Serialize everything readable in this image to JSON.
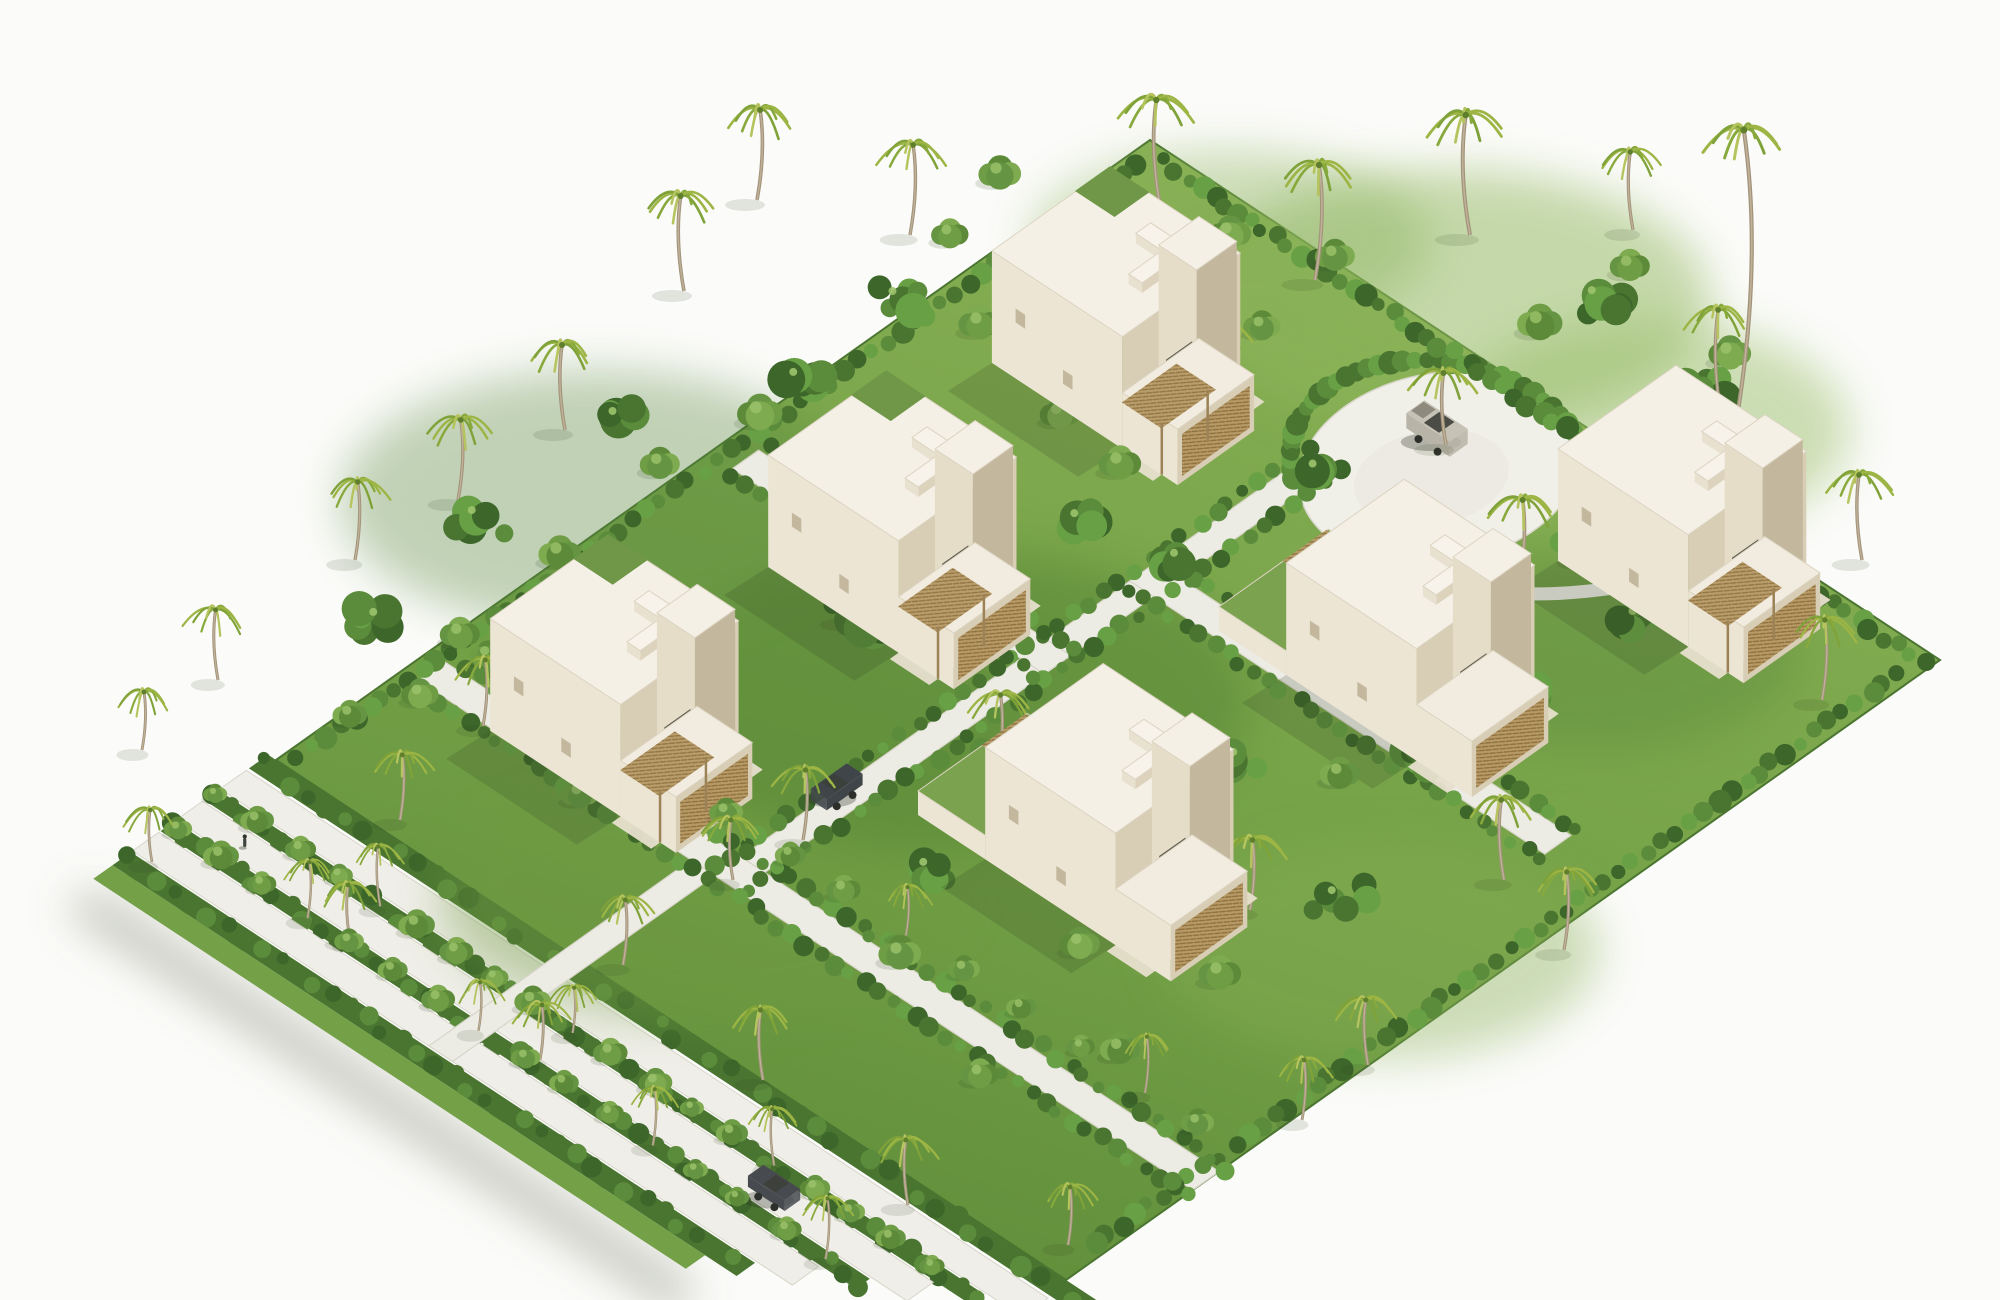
{
  "scene": {
    "description": "Isometric 3D architectural rendering of a tropical villa resort masterplan: six white concrete cube villas with roof terraces and rattan pergolas on a lush green site, a circular paved drop-off plaza with a grey SUV, diagonal white roads lined with hedges and palms, and a landscaped buffer of three parallel tree-lined lanes along the south-west boundary.",
    "palette": {
      "bg": "#fbfbf9",
      "grassHi": "#8ab155",
      "grass": "#74a147",
      "grassLo": "#5e8b39",
      "shrub1": "#3c662a",
      "shrub2": "#4a7531",
      "shrub3": "#5b8c3c",
      "shrub4": "#68a045",
      "leafHi": "#9cc36b",
      "road": "#ecebe4",
      "roadBright": "#efeee8",
      "roadEdge": "#d8d6ca",
      "roofTop": "#f4f0e6",
      "wallL": "#ece5d4",
      "wallR": "#d8cdb5",
      "wallShade": "#c3b89d",
      "rattan": "#b79a66",
      "rattanLine": "#8f713f",
      "glass": "#5c5b4e",
      "trunk": "#a2937a",
      "palmA": "#9cb544",
      "palmB": "#7fa239",
      "palmC": "#b5c45e",
      "palmD": "#88a93c",
      "treeA": "#5d8a39",
      "treeB": "#6f9d45",
      "treeC": "#7fab50",
      "treeD": "#659542",
      "suv": "#b8b4a7",
      "carDark": "#40454a",
      "shadow": "rgba(45,62,30,0.25)",
      "buildingShadow": "rgba(47,61,31,0.18)"
    },
    "villa_style": {
      "w": 0.165,
      "d": 0.135,
      "h": 112,
      "wing_h": 56,
      "tower_h": 126,
      "court_wall_h": 24
    },
    "villas": [
      {
        "id": "villa-1",
        "u": 0.185,
        "v": 0.206,
        "court": false,
        "green_roof": true,
        "pergola": true
      },
      {
        "id": "villa-2",
        "u": 0.227,
        "v": 0.5,
        "court": false,
        "green_roof": true,
        "pergola": true
      },
      {
        "id": "villa-3",
        "u": 0.196,
        "v": 0.79,
        "court": false,
        "green_roof": true,
        "pergola": true
      },
      {
        "id": "villa-4",
        "u": 0.64,
        "v": 0.625,
        "court": true,
        "green_roof": false,
        "pergola": false
      },
      {
        "id": "villa-5",
        "u": 0.667,
        "v": 0.305,
        "court": true,
        "green_roof": false,
        "pergola": false
      },
      {
        "id": "villa-6",
        "u": 0.74,
        "v": 0.06,
        "court": false,
        "green_roof": false,
        "pergola": true
      }
    ],
    "roundabout": {
      "u": 0.494,
      "v": 0.115,
      "rx": 142,
      "ry": 95,
      "rot": -10,
      "palm_base": [
        1446,
        445
      ]
    },
    "roads": [
      {
        "name": "spine-road",
        "axis": "v",
        "u": [
          0.395,
          0.425
        ],
        "v": [
          0.16,
          0.855
        ]
      },
      {
        "name": "cross-road-west",
        "axis": "u",
        "u": [
          0.03,
          0.425
        ],
        "v": [
          0.475,
          0.505
        ]
      },
      {
        "name": "cross-road-east",
        "axis": "u",
        "u": [
          0.395,
          0.92
        ],
        "v": [
          0.35,
          0.38
        ]
      },
      {
        "name": "southwest-boundary-road",
        "axis": "u",
        "u": [
          0.02,
          1.0
        ],
        "v": [
          0.825,
          0.855
        ]
      },
      {
        "name": "spine-connector",
        "axis": "v",
        "u": [
          0.365,
          0.395
        ],
        "v": [
          0.855,
          1.155
        ]
      }
    ],
    "path_to_villa6": [
      [
        0.565,
        0.185
      ],
      [
        0.625,
        0.225
      ],
      [
        0.69,
        0.16
      ],
      [
        0.73,
        0.105
      ]
    ],
    "strips": {
      "bands": [
        {
          "type": "hedge",
          "v": [
            1.0,
            1.022
          ],
          "uEnd": 1.04
        },
        {
          "type": "road",
          "v": [
            1.025,
            1.055
          ],
          "uEnd": 1.005
        },
        {
          "type": "hedge",
          "v": [
            1.057,
            1.073
          ],
          "uEnd": 0.96
        },
        {
          "type": "road",
          "v": [
            1.075,
            1.105
          ],
          "uEnd": 0.915
        },
        {
          "type": "hedge",
          "v": [
            1.107,
            1.123
          ],
          "uEnd": 0.87
        },
        {
          "type": "road",
          "v": [
            1.125,
            1.155
          ],
          "uEnd": 0.825
        },
        {
          "type": "hedge",
          "v": [
            1.157,
            1.178
          ],
          "uEnd": 0.78
        },
        {
          "type": "grass",
          "v": [
            1.178,
            1.2
          ],
          "uEnd": 0.74
        }
      ],
      "uStart": -0.01,
      "tree_rows": [
        {
          "v": 1.065,
          "uFrom": 0.0,
          "uTo": 0.95,
          "step": 0.05,
          "palm_every": 5
        },
        {
          "v": 1.115,
          "uFrom": 0.0,
          "uTo": 0.86,
          "step": 0.055,
          "palm_every": 4
        }
      ]
    },
    "inner_tree_row": {
      "v": 0.8,
      "uFrom": 0.05,
      "uTo": 0.95,
      "step": 0.075,
      "palm_every": 4
    },
    "hedgerows": [
      {
        "name": "northeast-edge-hedge",
        "a": [
          0.03,
          0.012
        ],
        "b": [
          0.99,
          0.012
        ],
        "step": 0.016,
        "r": 9
      },
      {
        "name": "southeast-edge-hedge",
        "a": [
          0.985,
          0.035
        ],
        "b": [
          0.985,
          0.955
        ],
        "step": 0.016,
        "r": 9
      },
      {
        "name": "northwest-edge-hedge",
        "a": [
          0.013,
          0.03
        ],
        "b": [
          0.013,
          0.985
        ],
        "step": 0.016,
        "r": 9
      },
      {
        "name": "spine-hedge-left",
        "a": [
          0.388,
          0.17
        ],
        "b": [
          0.388,
          0.85
        ],
        "step": 0.018,
        "r": 8
      },
      {
        "name": "spine-hedge-right",
        "a": [
          0.432,
          0.17
        ],
        "b": [
          0.432,
          0.85
        ],
        "step": 0.018,
        "r": 8
      },
      {
        "name": "cross-west-hedge-n",
        "a": [
          0.035,
          0.468
        ],
        "b": [
          0.42,
          0.468
        ],
        "step": 0.018,
        "r": 8
      },
      {
        "name": "cross-west-hedge-s",
        "a": [
          0.035,
          0.512
        ],
        "b": [
          0.42,
          0.512
        ],
        "step": 0.018,
        "r": 8
      },
      {
        "name": "cross-east-hedge-n",
        "a": [
          0.4,
          0.343
        ],
        "b": [
          0.92,
          0.343
        ],
        "step": 0.018,
        "r": 8
      },
      {
        "name": "cross-east-hedge-s",
        "a": [
          0.4,
          0.387
        ],
        "b": [
          0.92,
          0.387
        ],
        "step": 0.018,
        "r": 8
      },
      {
        "name": "boundary-hedge-n",
        "a": [
          0.02,
          0.818
        ],
        "b": [
          1.0,
          0.818
        ],
        "step": 0.018,
        "r": 8
      },
      {
        "name": "boundary-hedge-s",
        "a": [
          0.02,
          0.862
        ],
        "b": [
          1.0,
          0.862
        ],
        "step": 0.018,
        "r": 8
      }
    ],
    "lawn_patches": [
      [
        1450,
        300,
        260,
        130,
        "#8fb65c",
        0.5
      ],
      [
        1650,
        430,
        200,
        110,
        "#93ba5f",
        0.45
      ],
      [
        1380,
        950,
        220,
        110,
        "#87ae54",
        0.4
      ],
      [
        700,
        900,
        260,
        120,
        "#6f9a42",
        0.4
      ],
      [
        950,
        700,
        300,
        150,
        "#4c7a2f",
        0.4
      ],
      [
        600,
        500,
        260,
        130,
        "#55843a",
        0.35
      ],
      [
        1600,
        650,
        200,
        100,
        "#55843a",
        0.35
      ],
      [
        1230,
        240,
        200,
        90,
        "#88b158",
        0.4
      ]
    ],
    "palms": [
      [
        684,
        291,
        95,
        1.0
      ],
      [
        757,
        200,
        90,
        1.0
      ],
      [
        1160,
        205,
        105,
        1.05
      ],
      [
        910,
        235,
        90,
        0.95
      ],
      [
        1070,
        300,
        80,
        0.9
      ],
      [
        1315,
        280,
        115,
        1.05
      ],
      [
        1470,
        235,
        120,
        1.1
      ],
      [
        1733,
        440,
        310,
        1.15
      ],
      [
        1722,
        420,
        110,
        0.95
      ],
      [
        458,
        500,
        80,
        0.95
      ],
      [
        565,
        430,
        85,
        1.0
      ],
      [
        355,
        560,
        78,
        0.9
      ],
      [
        218,
        680,
        70,
        0.85
      ],
      [
        142,
        750,
        58,
        0.8
      ],
      [
        1862,
        560,
        85,
        0.95
      ],
      [
        1822,
        700,
        80,
        0.9
      ],
      [
        1504,
        880,
        80,
        0.95
      ],
      [
        1564,
        950,
        78,
        0.9
      ],
      [
        1368,
        1065,
        65,
        0.85
      ],
      [
        1302,
        1120,
        60,
        0.8
      ],
      [
        963,
        610,
        80,
        1.0
      ],
      [
        998,
        768,
        73,
        0.9
      ],
      [
        763,
        1080,
        70,
        0.9
      ],
      [
        623,
        965,
        65,
        0.85
      ],
      [
        908,
        1205,
        65,
        0.85
      ],
      [
        1068,
        1245,
        58,
        0.8
      ],
      [
        1446,
        445,
        72,
        1.0
      ],
      [
        1520,
        575,
        75,
        1.0
      ],
      [
        850,
        620,
        77,
        0.95
      ],
      [
        803,
        840,
        70,
        0.9
      ],
      [
        1220,
        400,
        77,
        0.95
      ],
      [
        400,
        820,
        65,
        0.85
      ],
      [
        152,
        862,
        52,
        0.75
      ],
      [
        1250,
        910,
        70,
        0.95
      ],
      [
        733,
        880,
        60,
        0.85
      ],
      [
        483,
        726,
        66,
        0.85
      ],
      [
        1633,
        230,
        78,
        0.9
      ],
      [
        540,
        1060,
        55,
        0.8
      ],
      [
        350,
        940,
        55,
        0.8
      ]
    ],
    "trees": [
      [
        1000,
        180,
        16
      ],
      [
        1090,
        260,
        18
      ],
      [
        950,
        240,
        14
      ],
      [
        1230,
        240,
        16
      ],
      [
        1335,
        262,
        15
      ],
      [
        1540,
        330,
        17
      ],
      [
        1630,
        272,
        15
      ],
      [
        1730,
        360,
        16
      ],
      [
        1262,
        332,
        14
      ],
      [
        1160,
        300,
        15
      ],
      [
        980,
        330,
        16
      ],
      [
        760,
        420,
        17
      ],
      [
        660,
        470,
        15
      ],
      [
        560,
        560,
        16
      ],
      [
        460,
        640,
        15
      ],
      [
        420,
        700,
        14
      ],
      [
        520,
        680,
        16
      ],
      [
        350,
        720,
        13
      ],
      [
        1120,
        470,
        16
      ],
      [
        1060,
        420,
        15
      ],
      [
        1500,
        640,
        16
      ],
      [
        1580,
        560,
        15
      ],
      [
        1660,
        470,
        16
      ],
      [
        1760,
        520,
        15
      ],
      [
        1440,
        720,
        16
      ],
      [
        1340,
        780,
        15
      ],
      [
        1180,
        900,
        16
      ],
      [
        1080,
        950,
        15
      ],
      [
        900,
        960,
        16
      ],
      [
        1020,
        840,
        15
      ],
      [
        1220,
        980,
        16
      ],
      [
        660,
        760,
        14
      ],
      [
        580,
        800,
        14
      ],
      [
        1120,
        1055,
        15
      ],
      [
        980,
        1080,
        14
      ],
      [
        870,
        430,
        15
      ]
    ],
    "shrub_clusters": [
      [
        860,
        620,
        55,
        7
      ],
      [
        1000,
        760,
        60,
        7
      ],
      [
        700,
        700,
        50,
        6
      ],
      [
        480,
        520,
        55,
        6
      ],
      [
        620,
        420,
        50,
        6
      ],
      [
        380,
        620,
        45,
        6
      ],
      [
        1520,
        690,
        60,
        7
      ],
      [
        1640,
        620,
        50,
        6
      ],
      [
        1600,
        300,
        55,
        6
      ],
      [
        1700,
        390,
        50,
        6
      ],
      [
        900,
        300,
        50,
        6
      ],
      [
        800,
        380,
        45,
        6
      ],
      [
        1340,
        900,
        55,
        6
      ],
      [
        1240,
        760,
        45,
        6
      ],
      [
        560,
        660,
        40,
        5
      ],
      [
        930,
        870,
        45,
        6
      ],
      [
        1318,
        470,
        36,
        5
      ],
      [
        1180,
        560,
        40,
        5
      ],
      [
        1420,
        760,
        40,
        5
      ],
      [
        1080,
        520,
        38,
        5
      ]
    ],
    "cars": [
      {
        "id": "suv-roundabout",
        "type": "suv",
        "x": 1437,
        "y": 438,
        "axis": "u",
        "color": "#b8b4a7"
      },
      {
        "id": "car-spine-road",
        "type": "sedan",
        "plan": [
          0.4,
          0.72
        ],
        "axis": "v",
        "color": "#40454a"
      },
      {
        "id": "car-buffer-road",
        "type": "sedan",
        "plan": [
          0.73,
          1.09
        ],
        "axis": "u",
        "color": "#474b4f"
      }
    ],
    "people": [
      {
        "plan": [
          0.06,
          1.09
        ]
      },
      {
        "plan": [
          0.66,
          0.19
        ]
      }
    ]
  }
}
